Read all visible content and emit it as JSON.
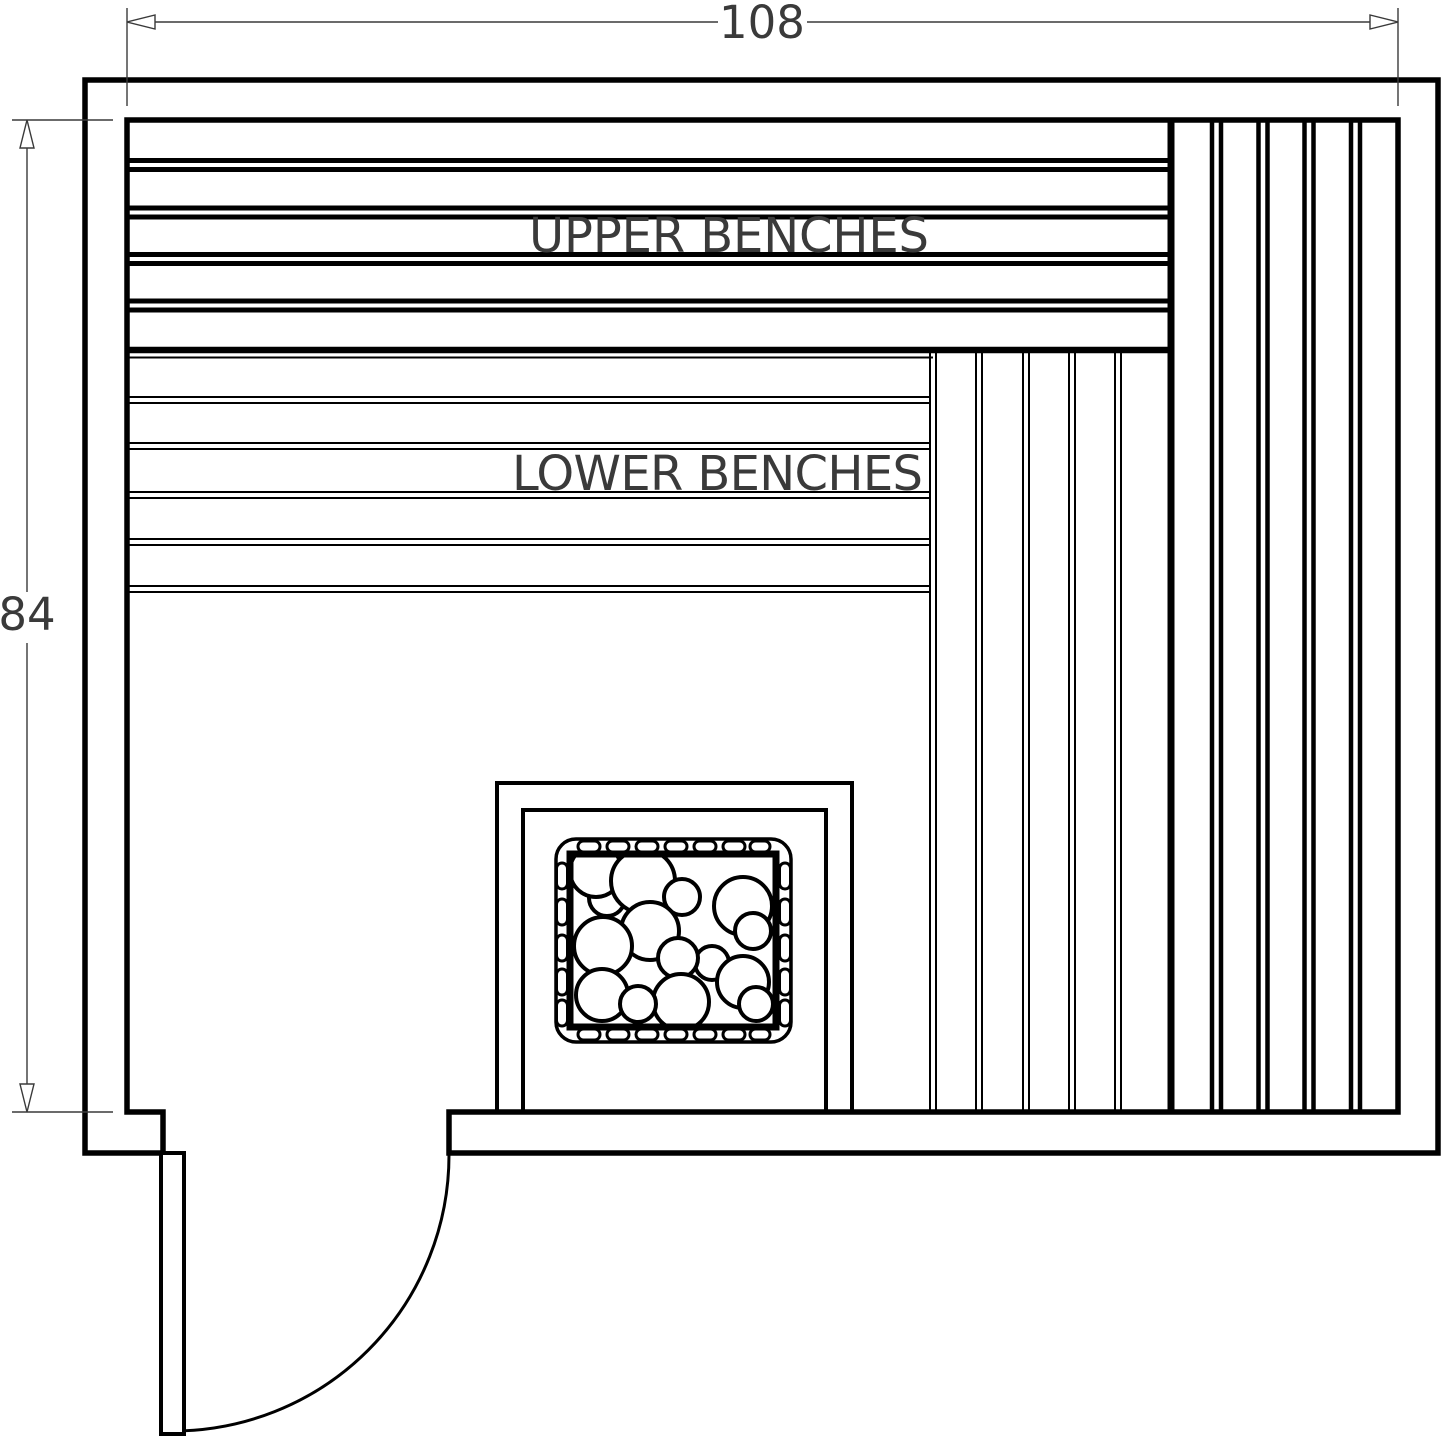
{
  "drawing": {
    "type": "sauna floor plan",
    "dimensions": {
      "width_inches": "108",
      "height_inches": "84"
    },
    "labels": {
      "upper_benches": "UPPER BENCHES",
      "lower_benches": "LOWER BENCHES"
    },
    "colors": {
      "line": "#000000",
      "dimension": "#3a3a3a",
      "background": "#ffffff"
    }
  }
}
